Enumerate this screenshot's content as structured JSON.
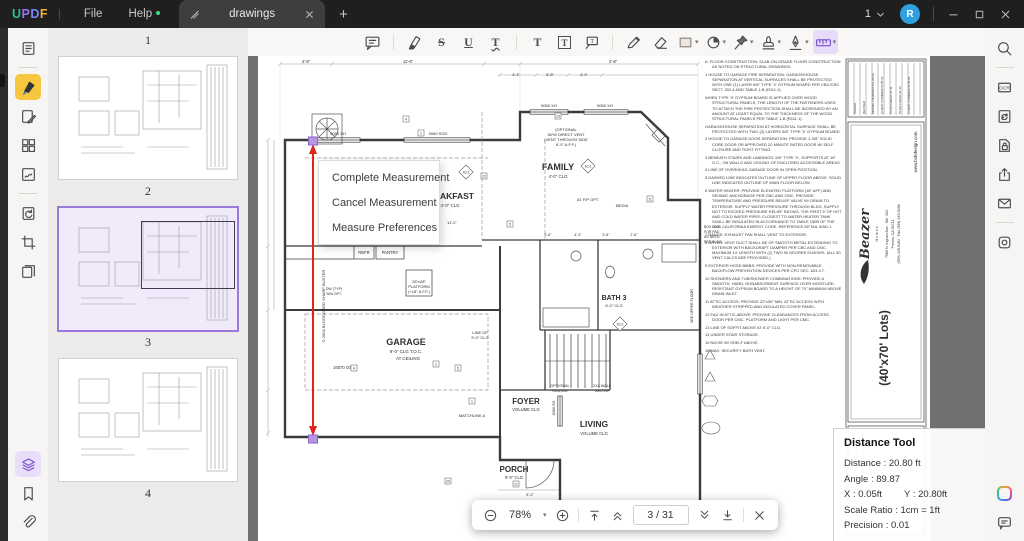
{
  "titlebar": {
    "logo": [
      {
        "ch": "U",
        "c": "#2fbe8f"
      },
      {
        "ch": "P",
        "c": "#9a6ff0"
      },
      {
        "ch": "D",
        "c": "#7b86f5"
      },
      {
        "ch": "F",
        "c": "#eeb23c"
      }
    ],
    "menus": [
      {
        "label": "File"
      },
      {
        "label": "Help",
        "badge": true
      }
    ],
    "tab": {
      "label": "drawings"
    },
    "window_count": "1",
    "avatar": "R"
  },
  "toolbar": {
    "tools": [
      {
        "icon": "note-icon"
      },
      {
        "divider": true
      },
      {
        "icon": "highlight-icon"
      },
      {
        "icon": "strikethrough-icon"
      },
      {
        "icon": "underline-icon"
      },
      {
        "icon": "squiggly-icon"
      },
      {
        "divider": true
      },
      {
        "icon": "text-icon"
      },
      {
        "icon": "textbox-icon"
      },
      {
        "icon": "callout-icon"
      },
      {
        "divider": true
      },
      {
        "icon": "pencil-icon"
      },
      {
        "icon": "eraser-icon"
      },
      {
        "icon": "shape-rect-icon",
        "dropdown": true
      },
      {
        "icon": "shape-circle-icon",
        "dropdown": true
      },
      {
        "icon": "pin-icon",
        "dropdown": true
      },
      {
        "icon": "stamp-icon",
        "dropdown": true
      },
      {
        "icon": "signature-icon",
        "dropdown": true
      },
      {
        "icon": "measure-icon",
        "dropdown": true,
        "active": true
      }
    ]
  },
  "left_rail": {
    "top": [
      {
        "icon": "reader-icon"
      },
      {
        "divider": true
      },
      {
        "icon": "annotate-icon",
        "active": "yellow"
      },
      {
        "icon": "edit-icon"
      },
      {
        "icon": "organize-icon"
      },
      {
        "icon": "sign-icon"
      },
      {
        "divider": true
      },
      {
        "icon": "convert-icon"
      },
      {
        "icon": "crop-icon"
      },
      {
        "icon": "extract-icon"
      }
    ],
    "bottom": [
      {
        "icon": "layers-icon",
        "active": "purple"
      },
      {
        "icon": "bookmark-icon"
      },
      {
        "icon": "attachment-icon"
      }
    ]
  },
  "right_rail": {
    "top": [
      {
        "icon": "search-icon"
      },
      {
        "divider": true
      },
      {
        "icon": "ocr-icon"
      },
      {
        "icon": "compress-icon"
      },
      {
        "icon": "protect-icon"
      },
      {
        "icon": "share-icon"
      },
      {
        "icon": "email-icon"
      },
      {
        "divider": true
      },
      {
        "icon": "capture-icon"
      }
    ],
    "bottom": [
      {
        "icon": "ai-icon"
      },
      {
        "icon": "chat-icon"
      }
    ]
  },
  "thumbnails": {
    "pages": [
      {
        "num": "1",
        "thumb": false
      },
      {
        "num": "2"
      },
      {
        "num": "3",
        "selected": true
      },
      {
        "num": "4"
      }
    ]
  },
  "context_menu": {
    "items": [
      "Complete Measurement",
      "Cancel Measurement",
      "Measure Preferences"
    ]
  },
  "distance_tool": {
    "title": "Distance Tool",
    "rows": [
      {
        "label": "Distance",
        "value": "20.80 ft"
      },
      {
        "label": "Angle",
        "value": "89.87"
      },
      {
        "label": "X",
        "value": "0.05ft",
        "label2": "Y",
        "value2": "20.80ft"
      },
      {
        "label": "Scale Ratio",
        "value": "1cm = 1ft"
      },
      {
        "label": "Precision",
        "value": "0.01"
      }
    ]
  },
  "status_bar": {
    "zoom": "78%",
    "page_display": "3 / 31"
  },
  "drawing": {
    "annotations": [
      {
        "t": "FAMILY",
        "x": 300,
        "y": 114,
        "s": 9,
        "b": 1
      },
      {
        "t": "4'-0\" CLG",
        "x": 300,
        "y": 122,
        "s": 4.4
      },
      {
        "t": "BREAKFAST",
        "x": 190,
        "y": 143,
        "s": 8.5,
        "b": 1
      },
      {
        "t": "4'-0\" CLG",
        "x": 192,
        "y": 151,
        "s": 4.4
      },
      {
        "t": "GARAGE",
        "x": 148,
        "y": 289,
        "s": 9,
        "b": 1
      },
      {
        "t": "9'-0\" CLG T.O.C.",
        "x": 148,
        "y": 297,
        "s": 4.4
      },
      {
        "t": "AT CEILING",
        "x": 150,
        "y": 304,
        "s": 4.4
      },
      {
        "t": "FOYER",
        "x": 268,
        "y": 348,
        "s": 8,
        "b": 1
      },
      {
        "t": "VOLUME CLG",
        "x": 268,
        "y": 355,
        "s": 4.2
      },
      {
        "t": "LIVING",
        "x": 336,
        "y": 371,
        "s": 8.5,
        "b": 1
      },
      {
        "t": "VOLUME CLG",
        "x": 336,
        "y": 379,
        "s": 4.2
      },
      {
        "t": "PORCH",
        "x": 256,
        "y": 416,
        "s": 8,
        "b": 1
      },
      {
        "t": "9'-0\" CLG",
        "x": 256,
        "y": 423,
        "s": 4.2
      },
      {
        "t": "BATH 3",
        "x": 356,
        "y": 244,
        "s": 7,
        "b": 1
      },
      {
        "t": "8'-0\" CLG",
        "x": 356,
        "y": 251,
        "s": 4
      },
      {
        "t": "REFR",
        "x": 106,
        "y": 198,
        "s": 4.2
      },
      {
        "t": "PANTRY",
        "x": 132,
        "y": 198,
        "s": 4.2
      },
      {
        "t": "28\"x28\"",
        "x": 161,
        "y": 227,
        "s": 4
      },
      {
        "t": "PLATFORM",
        "x": 161,
        "y": 232,
        "s": 4
      },
      {
        "t": "(+18\" A.F.F.)",
        "x": 161,
        "y": 237,
        "s": 4
      },
      {
        "t": "DW (TYP)",
        "x": 76,
        "y": 234,
        "s": 3.6
      },
      {
        "t": "W/A OPT.",
        "x": 76,
        "y": 239,
        "s": 3.6
      },
      {
        "t": "AT F/P OPT.",
        "x": 330,
        "y": 145,
        "s": 4
      },
      {
        "t": "MEDIA",
        "x": 364,
        "y": 151,
        "s": 4
      },
      {
        "t": "(OPTIONAL",
        "x": 308,
        "y": 75,
        "s": 4
      },
      {
        "t": "36\"W DIRECT VENT",
        "x": 308,
        "y": 80,
        "s": 4
      },
      {
        "t": "(VENT THROUGH SIDE",
        "x": 308,
        "y": 85,
        "s": 4
      },
      {
        "t": "6'-0\" A.F.F.)",
        "x": 308,
        "y": 90,
        "s": 4
      },
      {
        "t": "LINE OF",
        "x": 222,
        "y": 278,
        "s": 4
      },
      {
        "t": "9'-0\" CLG",
        "x": 222,
        "y": 283,
        "s": 4
      },
      {
        "t": "OPTIONAL",
        "x": 302,
        "y": 331,
        "s": 3.8
      },
      {
        "t": "RAILING",
        "x": 302,
        "y": 336,
        "s": 3.8
      },
      {
        "t": "2X4 WALL",
        "x": 344,
        "y": 331,
        "s": 3.8
      },
      {
        "t": "BELOW",
        "x": 344,
        "y": 336,
        "s": 3.8
      },
      {
        "t": "MATCHLINE A",
        "x": 214,
        "y": 361,
        "s": 4
      },
      {
        "t": "16070 OSD",
        "x": 86,
        "y": 313,
        "s": 4.2
      },
      {
        "t": "5050 SH",
        "x": 80,
        "y": 79,
        "s": 4
      },
      {
        "t": "5060 SGD",
        "x": 180,
        "y": 79,
        "s": 4
      },
      {
        "t": "5060 XO",
        "x": 291,
        "y": 51,
        "s": 4
      },
      {
        "t": "5060 XO",
        "x": 347,
        "y": 51,
        "s": 4
      },
      {
        "t": "3060 SG",
        "x": 297,
        "y": 352,
        "s": 3.8,
        "r": -90
      },
      {
        "t": "3060 SH",
        "x": 346,
        "y": 471,
        "s": 3.8
      },
      {
        "t": "BOX OUT",
        "x": 446,
        "y": 172,
        "s": 3.5,
        "a": "start"
      },
      {
        "t": "FOR PAD",
        "x": 446,
        "y": 177,
        "s": 3.5,
        "a": "start"
      },
      {
        "t": "AS NEED.",
        "x": 446,
        "y": 182,
        "s": 3.5,
        "a": "start"
      },
      {
        "t": "PER BLDG",
        "x": 446,
        "y": 187,
        "s": 3.5,
        "a": "start"
      },
      {
        "t": "SEE UPPER FLOOR",
        "x": 435,
        "y": 250,
        "s": 3.6,
        "r": -90
      },
      {
        "t": "4'-6\"",
        "x": 48,
        "y": 6.8,
        "s": 4.2
      },
      {
        "t": "11'-6\"",
        "x": 150,
        "y": 6.8,
        "s": 4.2
      },
      {
        "t": "2'-8\"",
        "x": 355,
        "y": 6.8,
        "s": 4.2
      },
      {
        "t": "4'-4\"",
        "x": 258,
        "y": 20,
        "s": 4
      },
      {
        "t": "5'-8\"",
        "x": 292,
        "y": 20,
        "s": 4
      },
      {
        "t": "4'-4\"",
        "x": 326,
        "y": 20,
        "s": 4
      },
      {
        "t": "11'-2\"",
        "x": 194,
        "y": 168,
        "s": 4
      },
      {
        "t": "5'-8\"",
        "x": 290,
        "y": 180,
        "s": 3.6
      },
      {
        "t": "4'-3\"",
        "x": 320,
        "y": 180,
        "s": 3.6
      },
      {
        "t": "3'-8\"",
        "x": 348,
        "y": 180,
        "s": 3.6
      },
      {
        "t": "2'-6\"",
        "x": 376,
        "y": 180,
        "s": 3.6
      },
      {
        "t": "5'-2\"",
        "x": 272,
        "y": 440,
        "s": 3.8
      },
      {
        "t": "8'-0\"",
        "x": 272,
        "y": 447,
        "s": 3.8
      },
      {
        "t": "5'-2\"",
        "x": 316,
        "y": 474,
        "s": 3.8
      },
      {
        "t": "5'-0\"",
        "x": 400,
        "y": 474,
        "s": 3.8
      },
      {
        "t": "© 2004 BLOODGOOD SHARP BUSTER",
        "x": 67,
        "y": 250,
        "s": 4,
        "r": -90
      }
    ],
    "boxes": [
      {
        "n": "4",
        "x": 148,
        "y": 63
      },
      {
        "n": "1",
        "x": 163,
        "y": 77
      },
      {
        "n": "8",
        "x": 145,
        "y": 122
      },
      {
        "n": "22",
        "x": 226,
        "y": 120
      },
      {
        "n": "5",
        "x": 252,
        "y": 168
      },
      {
        "n": "11",
        "x": 392,
        "y": 143
      },
      {
        "n": "2",
        "x": 178,
        "y": 308
      },
      {
        "n": "5",
        "x": 200,
        "y": 312
      },
      {
        "n": "4",
        "x": 96,
        "y": 312
      },
      {
        "n": "1",
        "x": 214,
        "y": 345
      },
      {
        "n": "20",
        "x": 190,
        "y": 425
      },
      {
        "n": "21",
        "x": 258,
        "y": 428
      },
      {
        "n": "21",
        "x": 416,
        "y": 470
      },
      {
        "n": "23",
        "x": 300,
        "y": 60
      }
    ],
    "diamonds": [
      {
        "t": "A2.3",
        "x": 208,
        "y": 116
      },
      {
        "t": "A2.3",
        "x": 330,
        "y": 110
      },
      {
        "t": "A2.3",
        "x": 362,
        "y": 268
      }
    ],
    "notes": [
      "A. FLOOR CONSTRUCTION: SLAB-ON-GRADE FLOOR CONSTRUCTION AS NOTED ON STRUCTURAL DRAWINGS.",
      "1  HOUSE TO GARAGE FIRE SEPARATION: GARAGE/HOUSE SEPARATION AT VERTICAL SURFACES SHALL BE PROTECTED WITH ONE (1) LAYER 5/8\" TYPE 'X' GYPSUM BOARD PER CBC/CRC SECT. 302.4 AND TABLE 1-B (R111.1).",
      "WHEN TYPE 'X' GYPSUM BOARD IS APPLIED OVER WOOD STRUCTURAL PANELS, THE LENGTH OF THE FASTENERS USED TO ATTACH THE FIRE PROTECTION SHALL BE INCREASED BY AN AMOUNT AT LEAST EQUAL TO THE THICKNESS OF THE WOOD STRUCTURAL PANELS PER TABLE 1-B (R111.1).",
      "GARAGE/HOUSE SEPARATION AT HORIZONTAL SURFACE SHALL BE PROTECTED WITH TWO (2) LAYERS 5/8\" TYPE 'X' GYPSUM BOARD.",
      "2  HOUSE TO GARAGE DOOR SEPARATION: PROVIDE 1-3/8\" SOLID CORE DOOR OR APPROVED 20 MINUTE RATED DOOR W/ SELF CLOSURE AND TIGHT FITTING.",
      "3  BENEATH STAIRS AND LANDINGS: 5/8\" TYPE 'X', SUPPORTS AT 16\" O.C., ON WALLS AND CEILING OF ENCLOSED ACCESSIBLE AREAS.",
      "4  LINE OF OVERHEAD GARAGE DOOR IN OPEN POSITION.",
      "5  DASHED LINE INDICATES OUTLINE OF UPPER FLOOR ABOVE.  SOLID LINE INDICATES OUTLINE OF MAIN FLOOR BELOW.",
      "6  WATER HEATER:  PROVIDE ELEVATED PLATFORM (18\" AFF) AND SEISMIC ANCHORAGE PER CBC AND CMC. PROVIDE TEMPERATURE AND PRESSURE RELIEF VALVE W/ DRAIN TO EXTERIOR. SUPPLY WATER PRESSURE THROUGH BLDG. SUPPLY NOT TO EXCEED PRESSURE RELIEF RATING. THE FIRST 5' OF HOT AND COLD WATER PIPES CLOSEST TO WATER HEATER TANK SHALL BE INSULATED IN ACCORDANCE TO TABLE 150B OF THE 2005 CALIFORNIA ENERGY CODE. REFERENCE DETAIL 5/AD.1.",
      "7  RANGE: EXHAUST FAN SHALL VENT TO EXTERIOR.",
      "8  DRYER: VENT DUCT SHALL BE OF SMOOTH METAL EXTENDING TO EXTERIOR WITH BACKDRAFT DAMPER PER CBC AND CMC. MAXIMUM 14' LENGTH WITH (2) TWO 90 DEGREE ELBOWS. (ALL 90 VENT CALCS ARE PROVIDED.)",
      "9  EXTERIOR HOSE BIBBS:  PROVIDE WITH NON-REMOVABLE BACKFLOW PREVENTION DEVICES PER CPC SEC. 603.4.7.",
      "10  SHOWERS AND TUB/SHOWER COMBINATIONS: PROVIDE A SMOOTH, HARD, NONABSORBENT SURFACE OVER MOISTURE-RESISTANT GYPSUM BOARD TO A HEIGHT OF 70\" MINIMUM ABOVE DRAIN INLET.",
      "11  ATTIC ACCESS: PROVIDE 22\"x30\" MIN. ATTIC ACCESS WITH WEATHER STRIPPED AND INSULATED COVER PANEL.",
      "12  FAU IN ATTIC ABOVE: PROVIDE CLEARANCES FROM ACCESS DOOR PER CMC. PLATFORM AND LIGHT PER CMC.",
      "13  LINE OF SOFFIT ABOVE AT 8'-0\" CLG.",
      "14  UNDER STAIR STORAGE.",
      "15  NICHE W/ SHELF ABOVE.",
      "16  MAX. SECURITY BATH VENT."
    ],
    "title_block": {
      "brand": "Beazer",
      "brand_sub": "H o m e s",
      "addr": [
        "7580 N. Ingram Ave., Ste. 104",
        "Fresno, CA 93711",
        "(559) 449-9494  ·  Fax (559) 449-9498"
      ],
      "web": "www.bsbdesign.com",
      "lots": "(40'x70' Lots)",
      "offices": [
        "Divisions: Sacramento · Chicago · Phoenix · Dallas · Costa Mesa",
        "Des Moines · Boston · Chicago · Tampa · Denver · Fresno · Las Vegas · Atlanta"
      ],
      "rev_labels": [
        "ISSUED",
        "REVISED",
        "MRDGE TRANSMITTAL  05-22",
        "CLIENT COMMENTS  05-31",
        "PLAN CHECK  07-11",
        "PLAN CHECK  01-13",
        "CLIENT COMMENTS  05-04"
      ]
    }
  }
}
